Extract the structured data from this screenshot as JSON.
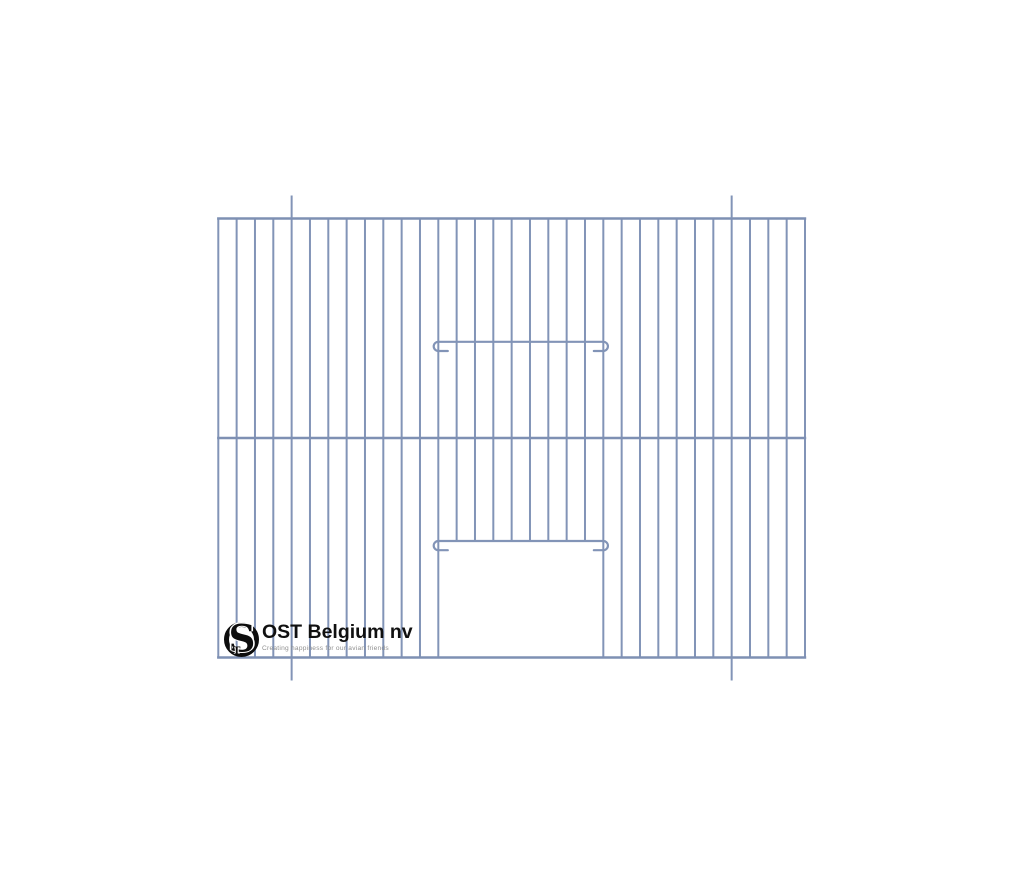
{
  "page": {
    "width": 1024,
    "height": 878,
    "background": "#ffffff"
  },
  "logo": {
    "monogram_s": "S",
    "monogram_t": "T",
    "company": "OST Belgium nv",
    "tagline": "Creating happiness for our avian friends",
    "ink_color": "#0d0d0d",
    "tagline_color": "#8f8f8f"
  },
  "drawing": {
    "name": "bird-cage-front-panel",
    "wire_color": "#8294b7",
    "rail_color": "#7e90b3",
    "bar_stroke_width": 2,
    "rail_stroke_width": 2.4,
    "frame": {
      "left": 218.3,
      "right": 805.0,
      "top": 218.5,
      "middle": 438.0,
      "bottom": 657.5
    },
    "bars": {
      "count": 33
    },
    "extensions": {
      "bar_indexes": [
        4,
        28
      ],
      "overhang_top": 23,
      "overhang_bottom": 23
    },
    "door": {
      "left_bar_index": 12,
      "right_bar_index": 21
    },
    "sliders": [
      {
        "wire_y": 341.8,
        "hook_radius": 4.6,
        "tail_length": 9.5
      },
      {
        "wire_y": 541.0,
        "hook_radius": 4.6,
        "tail_length": 9.5
      }
    ]
  }
}
